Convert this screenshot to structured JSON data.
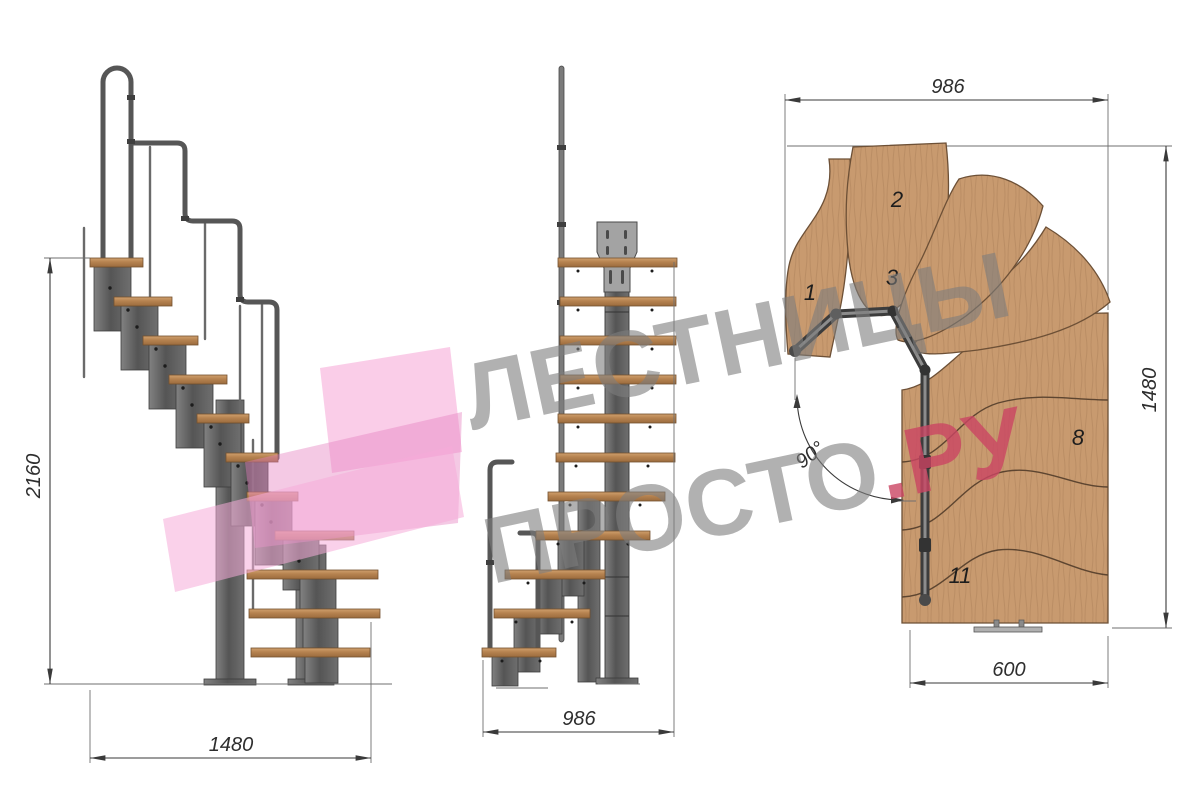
{
  "views": {
    "side": {
      "dim_height": "2160",
      "dim_length": "1480"
    },
    "front": {
      "dim_width": "986"
    },
    "plan": {
      "dim_top": "986",
      "dim_right": "1480",
      "dim_bottom": "600",
      "angle_label": "90°",
      "step_labels": [
        "1",
        "2",
        "3",
        "8",
        "11"
      ]
    }
  },
  "watermark": {
    "line1": "ЛЕСТНИЦЫ",
    "line2": "ПРОСТО",
    "line2_suffix": ".РУ",
    "gray": "#7d7d7d",
    "pink": "#cb4563",
    "logo_pink": "#f4a8d4"
  },
  "colors": {
    "background": "#ffffff",
    "wood_elevation": "#b5824f",
    "wood_plan": "#c89a6f",
    "metal": "#6a6a6a",
    "drawing_line": "#3a3a3a"
  }
}
